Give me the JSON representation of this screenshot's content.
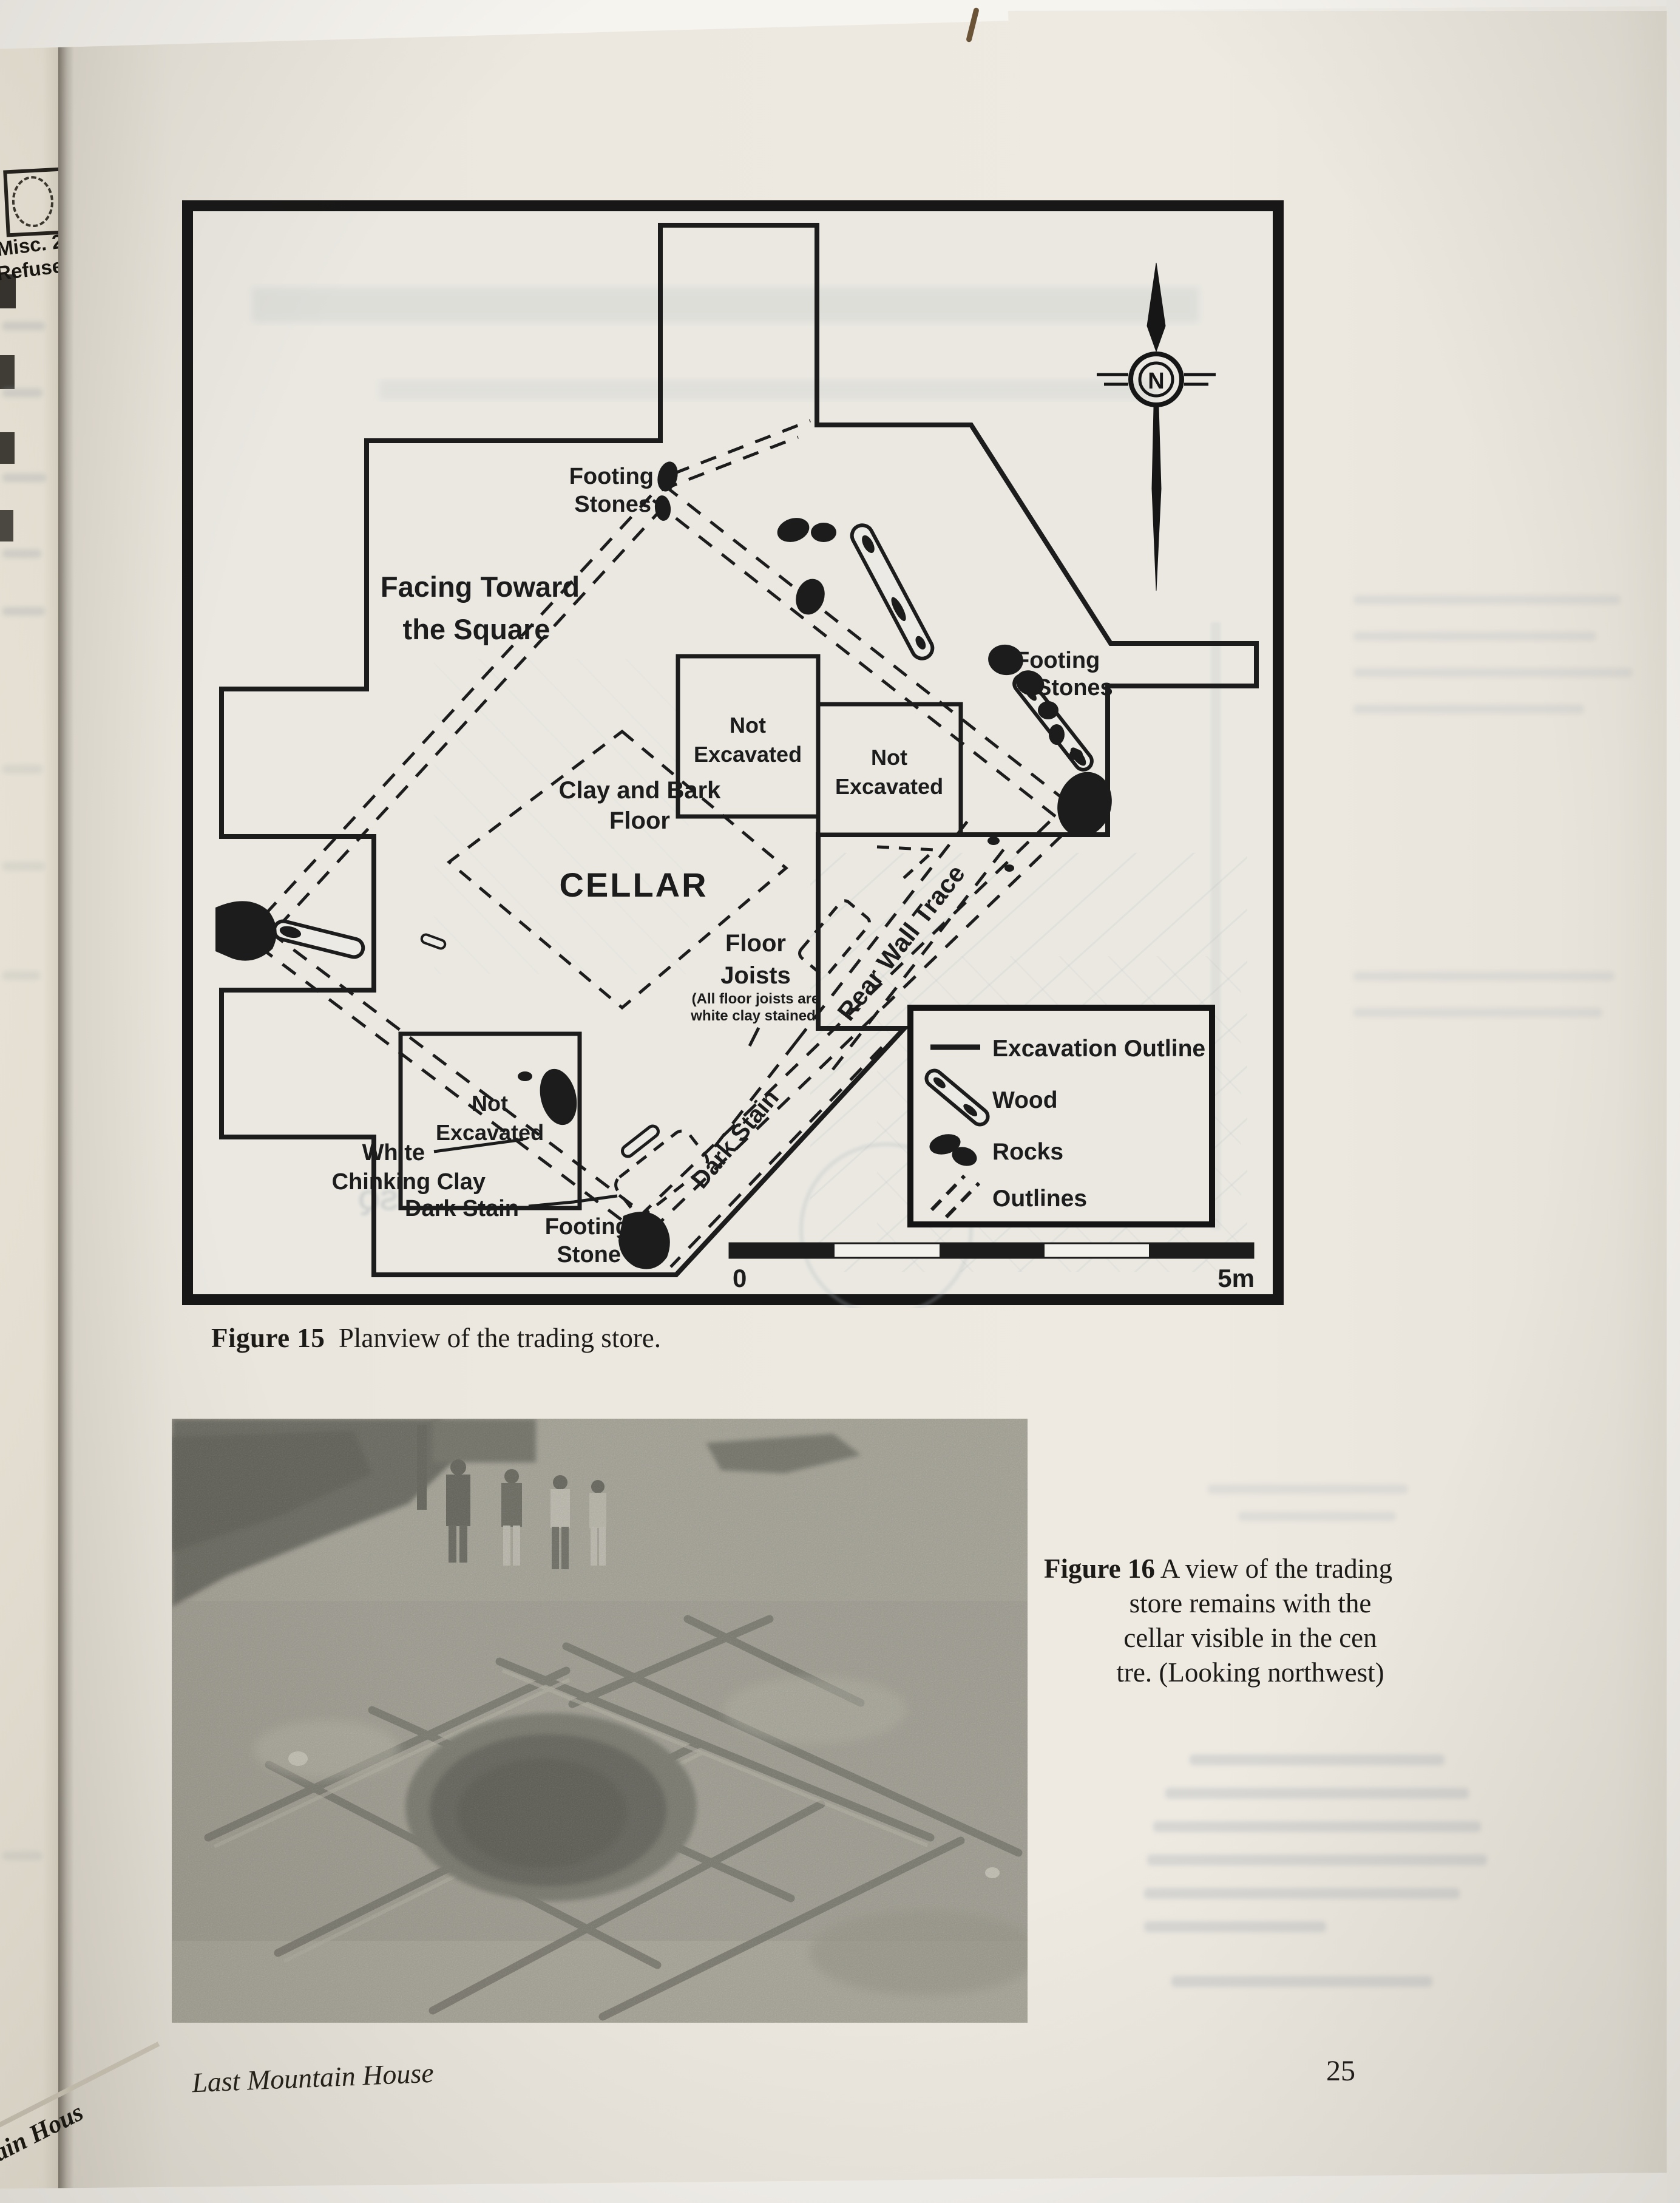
{
  "figure15": {
    "caption": {
      "label": "Figure 15",
      "text": "Planview of the trading store."
    },
    "labels": {
      "footing": "Footing",
      "stones": "Stones",
      "stone": "Stone",
      "facing_line1": "Facing Toward",
      "facing_line2": "the Square",
      "not": "Not",
      "excavated": "Excavated",
      "clay_line1": "Clay and Bark",
      "floor": "Floor",
      "cellar": "CELLAR",
      "joists": "Joists",
      "joists_note_line1": "(All floor joists are",
      "joists_note_line2": "white clay stained)",
      "rear_wall_trace": "Rear Wall Trace",
      "white": "White",
      "chinking_clay": "Chinking Clay",
      "dark_stain": "Dark Stain",
      "north_letter": "N",
      "scale_start": "0",
      "scale_end": "5m"
    },
    "legend": {
      "items": [
        {
          "icon": "solid-line",
          "label": "Excavation Outline"
        },
        {
          "icon": "wood-shape",
          "label": "Wood"
        },
        {
          "icon": "rock-blobs",
          "label": "Rocks"
        },
        {
          "icon": "dashed-lines",
          "label": "Outlines"
        }
      ]
    },
    "ink_color": "#1c1c1c",
    "paper_color": "#eae8e1"
  },
  "figure16": {
    "caption": {
      "label": "Figure 16",
      "lines": [
        "A view of the trading",
        "store remains with the",
        "cellar visible in the cen",
        "tre. (Looking northwest)"
      ]
    }
  },
  "footer": {
    "running_title": "Last Mountain House",
    "page_number": "25"
  },
  "adjacent_page": {
    "misc_line1": "Misc. 2",
    "misc_line2": "Refuse Pi",
    "corner_fragment": "tain Hous"
  }
}
